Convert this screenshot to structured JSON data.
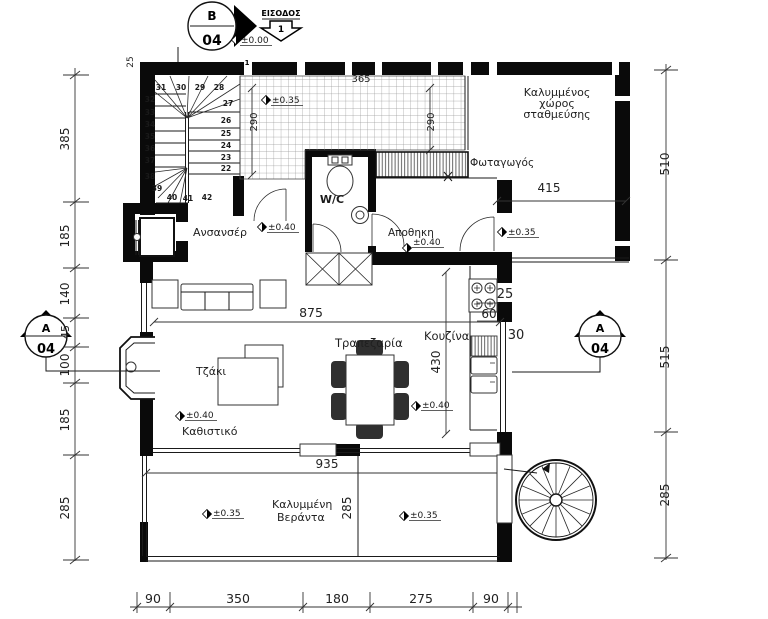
{
  "plan": {
    "markers": {
      "b": {
        "letter": "B",
        "num": "04"
      },
      "a_left": {
        "letter": "A",
        "num": "04"
      },
      "a_right": {
        "letter": "A",
        "num": "04"
      }
    },
    "entrance": {
      "label": "ΕΙΣΟΔΟΣ",
      "number": "1",
      "step": "1"
    },
    "rooms": {
      "parking1": "Καλυμμένος",
      "parking2": "χώρος",
      "parking3": "σταθμεύσης",
      "lightwell": "Φωταγωγός",
      "elevator": "Ανσανσέρ",
      "wc": "W/C",
      "storage": "Αποθηκη",
      "dining": "Τραπεζαρία",
      "kitchen": "Κουζίνα",
      "fireplace": "Τζάκι",
      "living": "Καθιστικό",
      "veranda1": "Καλυμμένη",
      "veranda2": "Βεράντα"
    },
    "levels": {
      "zero": "±0.00",
      "porch": "±0.35",
      "parking": "±0.35",
      "lobby": "±0.40",
      "storage": "±0.40",
      "kitchen": "±0.40",
      "living": "±0.40",
      "veranda_l": "±0.35",
      "veranda_r": "±0.35"
    },
    "dims": {
      "left": [
        "385",
        "185",
        "140",
        "45",
        "100",
        "185",
        "285"
      ],
      "right": [
        "510",
        "515",
        "285"
      ],
      "bottom": [
        "90",
        "350",
        "180",
        "275",
        "90"
      ],
      "entry_width": "365",
      "porch_depth_l": "290",
      "porch_depth_r": "290",
      "parking_width": "415",
      "living_width": "875",
      "kitchen_depth": "430",
      "veranda_width": "935",
      "veranda_depth": "285",
      "counter_25": "25",
      "counter_60": "60",
      "wall_30": "30",
      "corner_25": "25"
    },
    "stairs": [
      "22",
      "23",
      "24",
      "25",
      "26",
      "27",
      "28",
      "29",
      "30",
      "31",
      "32",
      "33",
      "34",
      "35",
      "36",
      "37",
      "38",
      "39",
      "40",
      "41",
      "42"
    ],
    "colors": {
      "wc": "#4444cc",
      "wall": "#0a0a0a"
    }
  }
}
